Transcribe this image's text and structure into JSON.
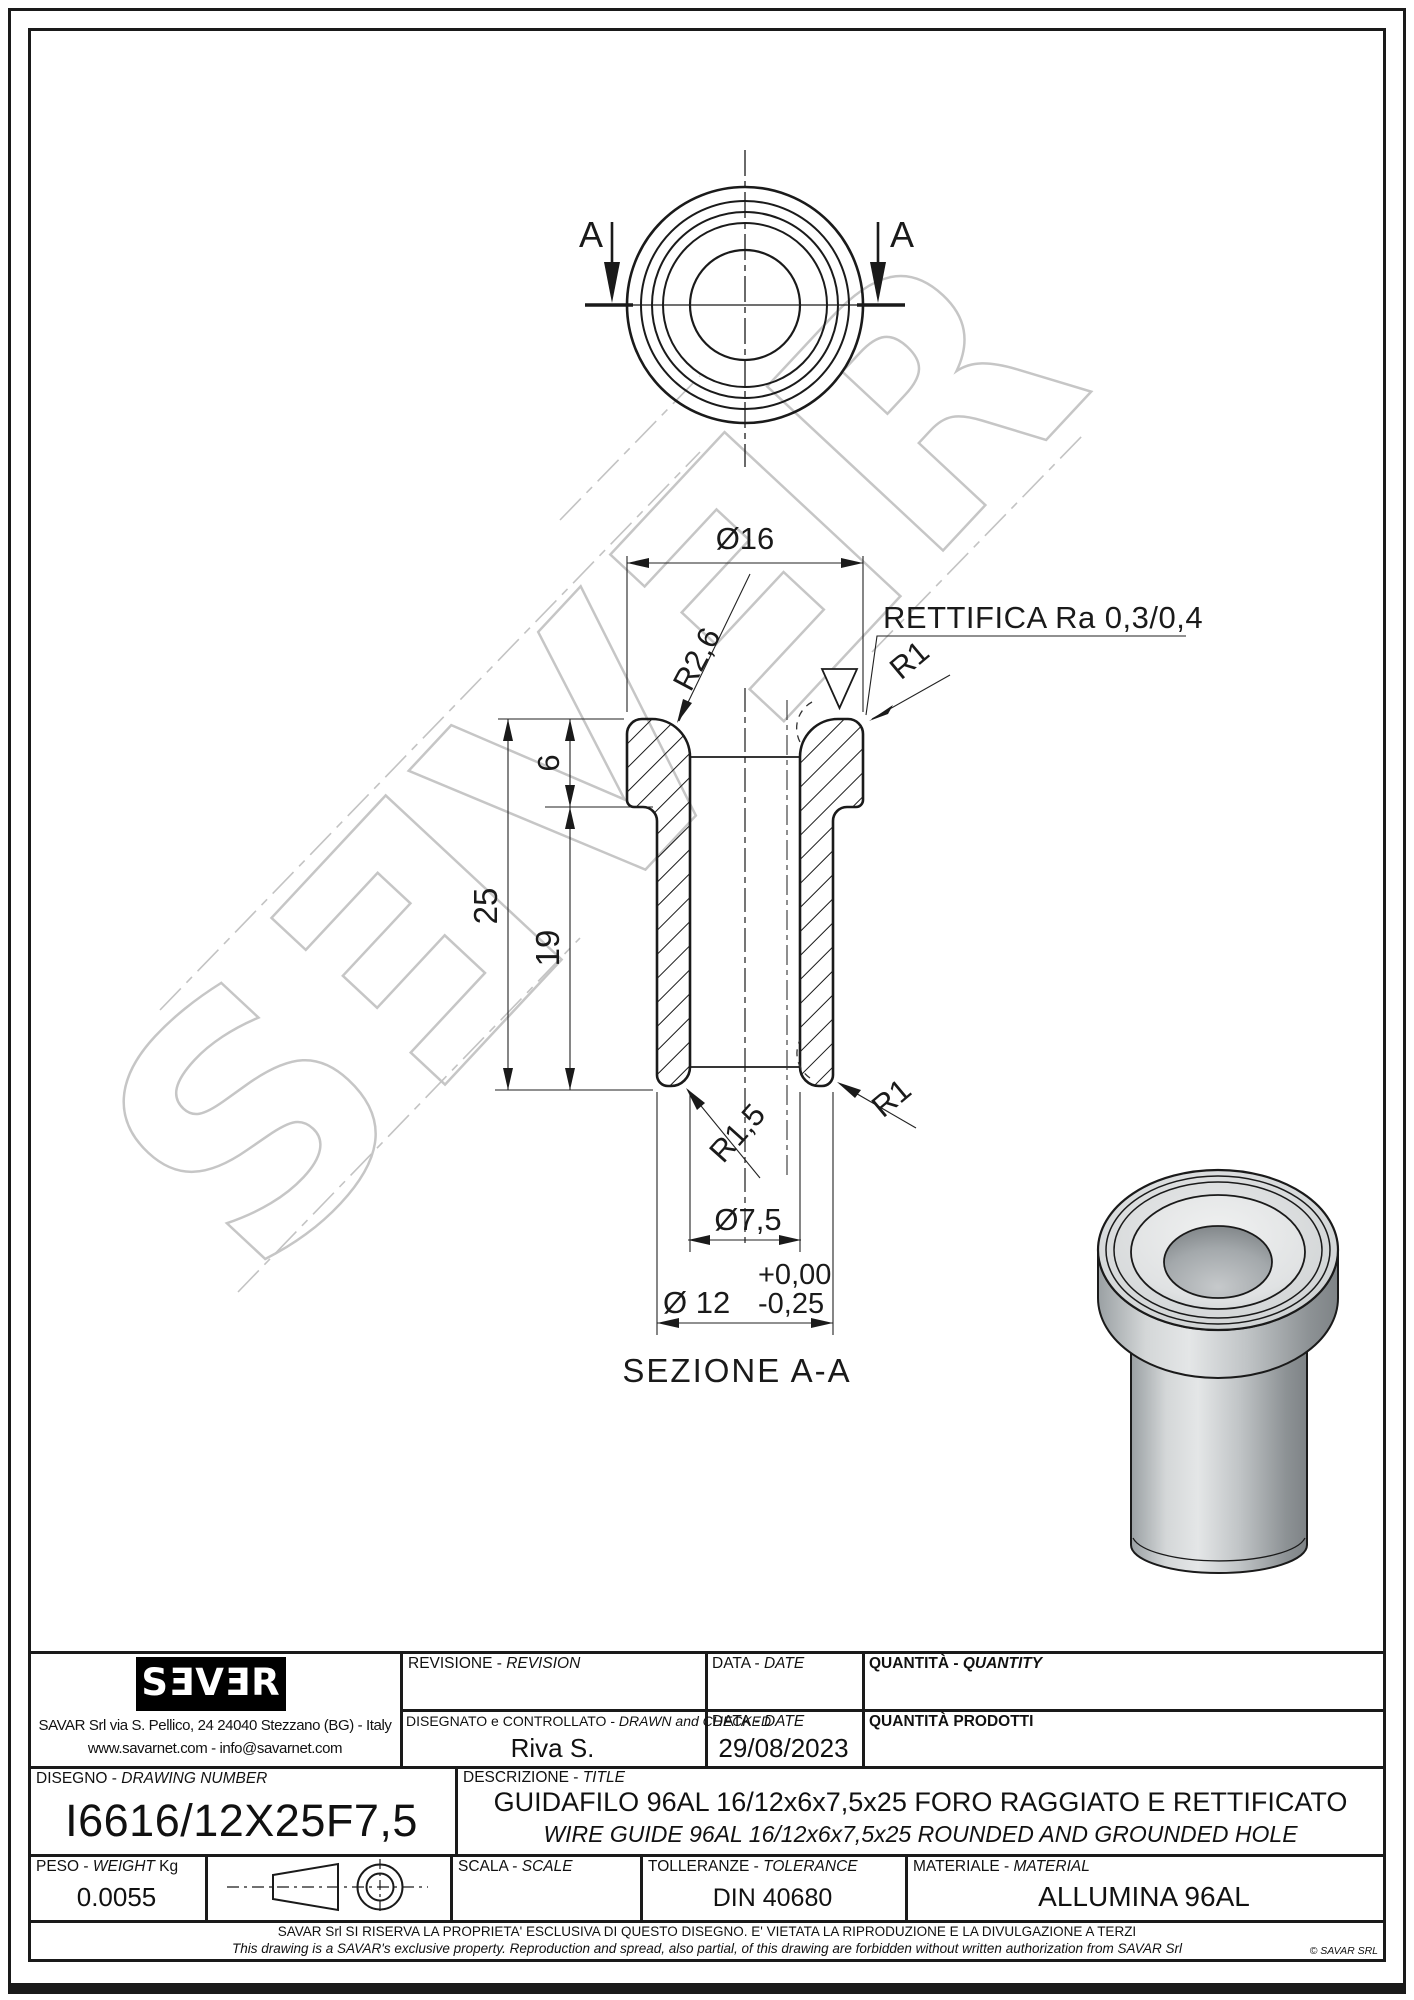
{
  "drawing": {
    "top_view": {
      "section_label_left": "A",
      "section_label_right": "A"
    },
    "dims": {
      "d16": "Ø16",
      "r26": "R2,6",
      "grind": "RETTIFICA Ra 0,3/0,4",
      "r1_top": "R1",
      "h6": "6",
      "h25": "25",
      "h19": "19",
      "r15": "R1,5",
      "r1_bottom": "R1",
      "d75": "Ø7,5",
      "tol_plus": "+0,00",
      "d12": "Ø 12",
      "tol_minus": "-0,25"
    },
    "section_caption": "SEZIONE A-A",
    "watermark": "SƎVƎR"
  },
  "title_block": {
    "logo_text": "SƎVƎR",
    "address_line1": "SAVAR Srl via S. Pellico, 24  24040 Stezzano (BG) - Italy",
    "address_line2": "www.savarnet.com  -  info@savarnet.com",
    "revision_label": "REVISIONE - ",
    "revision_label_en": "REVISION",
    "drawn_label": "DISEGNATO e CONTROLLATO - ",
    "drawn_label_en": "DRAWN and CHECKED",
    "drawn_value": "Riva S.",
    "date_label": "DATA - ",
    "date_label_en": "DATE",
    "date_value": "29/08/2023",
    "quantity_label": "QUANTITÀ - ",
    "quantity_label_en": "QUANTITY",
    "quantity_produced_label": "QUANTITÀ  PRODOTTI",
    "drawing_number_label": "DISEGNO - ",
    "drawing_number_label_en": "DRAWING NUMBER",
    "drawing_number": "I6616/12X25F7,5",
    "description_label": "DESCRIZIONE - ",
    "description_label_en": "TITLE",
    "description_line1": "GUIDAFILO 96AL 16/12x6x7,5x25 FORO RAGGIATO E RETTIFICATO",
    "description_line2": "WIRE GUIDE 96AL 16/12x6x7,5x25 ROUNDED AND GROUNDED HOLE",
    "weight_label": "PESO - ",
    "weight_label_en": "WEIGHT",
    "weight_unit": " Kg",
    "weight_value": "0.0055",
    "scale_label": "SCALA - ",
    "scale_label_en": "SCALE",
    "tolerance_label": "TOLLERANZE - ",
    "tolerance_label_en": "TOLERANCE",
    "tolerance_value": "DIN 40680",
    "material_label": "MATERIALE - ",
    "material_label_en": "MATERIAL",
    "material_value": "ALLUMINA 96AL",
    "disclaimer_it": "SAVAR Srl SI RISERVA LA PROPRIETA' ESCLUSIVA DI QUESTO DISEGNO. E' VIETATA LA RIPRODUZIONE E LA DIVULGAZIONE A TERZI",
    "disclaimer_en": "This drawing is a SAVAR's exclusive property. Reproduction and spread, also partial, of this drawing are forbidden without written authorization from SAVAR Srl",
    "copyright": "© SAVAR SRL"
  }
}
